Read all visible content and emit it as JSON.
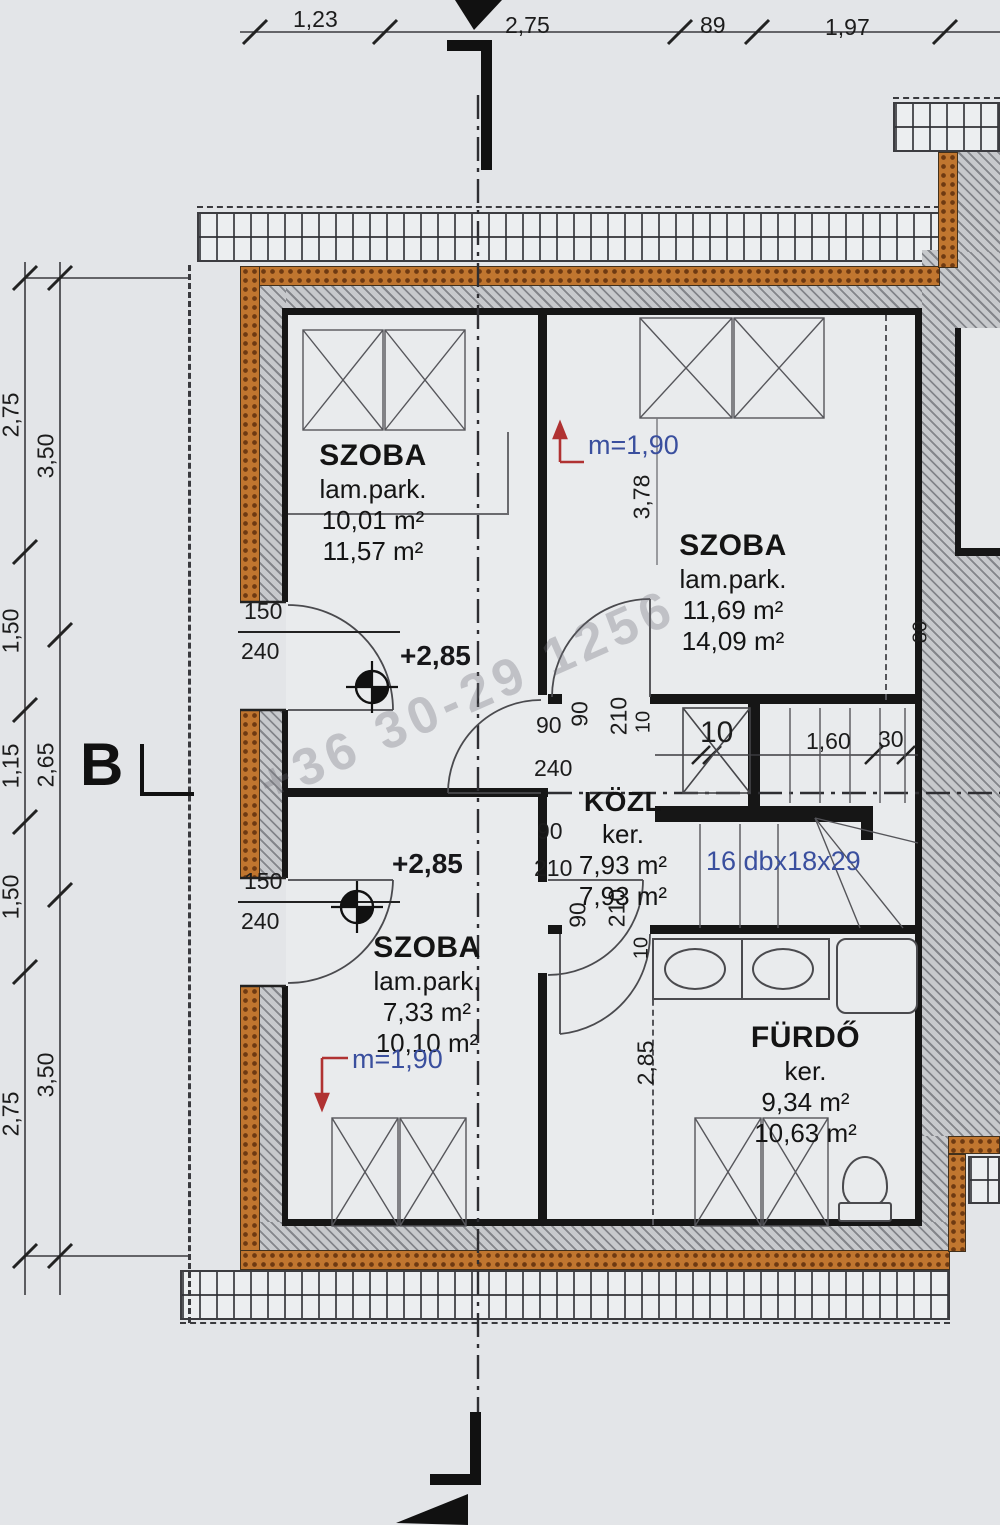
{
  "colors": {
    "annotation_blue": "#3a4f9e",
    "marker_red": "#b03232",
    "insulation_orange": "#c0762f"
  },
  "watermark": {
    "text": "+36 30-29 1256"
  },
  "dim_top": {
    "d1": "1,23",
    "d2": "2,75",
    "d3": "89",
    "d4": "1,97"
  },
  "dim_left_outer": {
    "d1": "2,75",
    "d2": "1,50",
    "d3": "1,15",
    "d4": "1,50",
    "d5": "2,75"
  },
  "dim_left_inner": {
    "d1": "3,50",
    "d2": "2,65",
    "d3": "3,50"
  },
  "section": {
    "label": "B"
  },
  "rooms": {
    "szoba_tl": {
      "name": "SZOBA",
      "floor": "lam.park.",
      "area_net": "10,01 m²",
      "area_gross": "11,57 m²"
    },
    "szoba_tr": {
      "name": "SZOBA",
      "floor": "lam.park.",
      "area_net": "11,69 m²",
      "area_gross": "14,09 m²"
    },
    "szoba_bl": {
      "name": "SZOBA",
      "floor": "lam.park.",
      "area_net": "7,33 m²",
      "area_gross": "10,10 m²"
    },
    "kozl": {
      "name": "KÖZL",
      "floor": "ker.",
      "area_net": "7,93 m²",
      "area_gross": "7,93 m²"
    },
    "furdo": {
      "name": "FÜRDŐ",
      "floor": "ker.",
      "area_net": "9,34 m²",
      "area_gross": "10,63 m²"
    }
  },
  "levels": {
    "upper": "+2,85",
    "lower": "+2,85"
  },
  "heights": {
    "upper": "m=1,90",
    "lower": "m=1,90"
  },
  "stair": {
    "steps": "16 dbx18x29",
    "seg1": "10",
    "seg2": "1,60",
    "seg3": "30"
  },
  "doors": {
    "left_top": {
      "w": "150",
      "h": "240"
    },
    "left_bottom": {
      "w": "150",
      "h": "240"
    },
    "corridor_width": "240",
    "top_cluster": {
      "a": "90",
      "b": "90",
      "c": "210",
      "d": "10"
    },
    "bottom_cluster": {
      "a": "90",
      "b": "210",
      "c": "90",
      "d": "210",
      "e": "10"
    }
  },
  "dims_misc": {
    "v378": "3,78",
    "v285": "2,85",
    "v80": "80"
  }
}
